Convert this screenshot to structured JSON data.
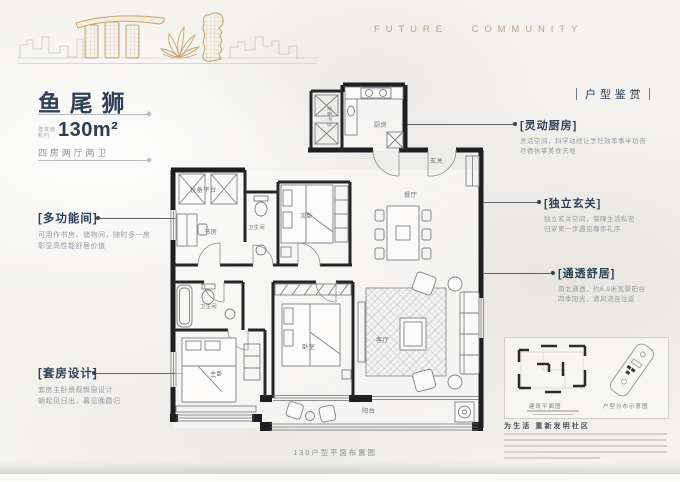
{
  "header": {
    "brand": "FUTURE COMMUNITY"
  },
  "unit": {
    "name": "鱼尾狮",
    "area_note": "建筑面积约",
    "area": "130m²",
    "layout": "四房两厅两卫"
  },
  "section_title": "户型鉴赏",
  "annotations_left": [
    {
      "title": "[多功能间]",
      "line1": "可用作书房、储物间，随时多一房",
      "line2": "彰显高性能舒居价值"
    },
    {
      "title": "[套房设计]",
      "line1": "套房主卧景观飘窗设计",
      "line2": "朝起见日出，暮见晚霞归"
    }
  ],
  "annotations_right": [
    {
      "title": "[灵动厨房]",
      "line1": "灵活空间，科学动线让烹饪效率事半功倍",
      "line2": "尽情执掌美食天地"
    },
    {
      "title": "[独立玄关]",
      "line1": "独立玄关空间，保障生活私密",
      "line2": "归家第一步遇见尊崇礼序"
    },
    {
      "title": "[通透舒居]",
      "line1": "南北通透，约6.9米宽景阳台",
      "line2": "四季阳光，清风流连往返"
    }
  ],
  "floorplan": {
    "caption": "130户型平面布置图",
    "rooms": {
      "equipment1": "设备平台",
      "equipment2": "设备平台",
      "study": "书房",
      "bath1": "卫生间",
      "bedroom2": "次卧",
      "kitchen": "厨房",
      "foyer": "玄关",
      "dining": "餐厅",
      "bath2": "卫生间",
      "master": "主卧",
      "bedroom3": "卧室",
      "living": "客厅",
      "balcony": "阳台"
    }
  },
  "legend": {
    "plan_caption": "建筑平面图",
    "dist_caption": "户型分布示意图",
    "slogan": "为生活 重新发明社区"
  }
}
